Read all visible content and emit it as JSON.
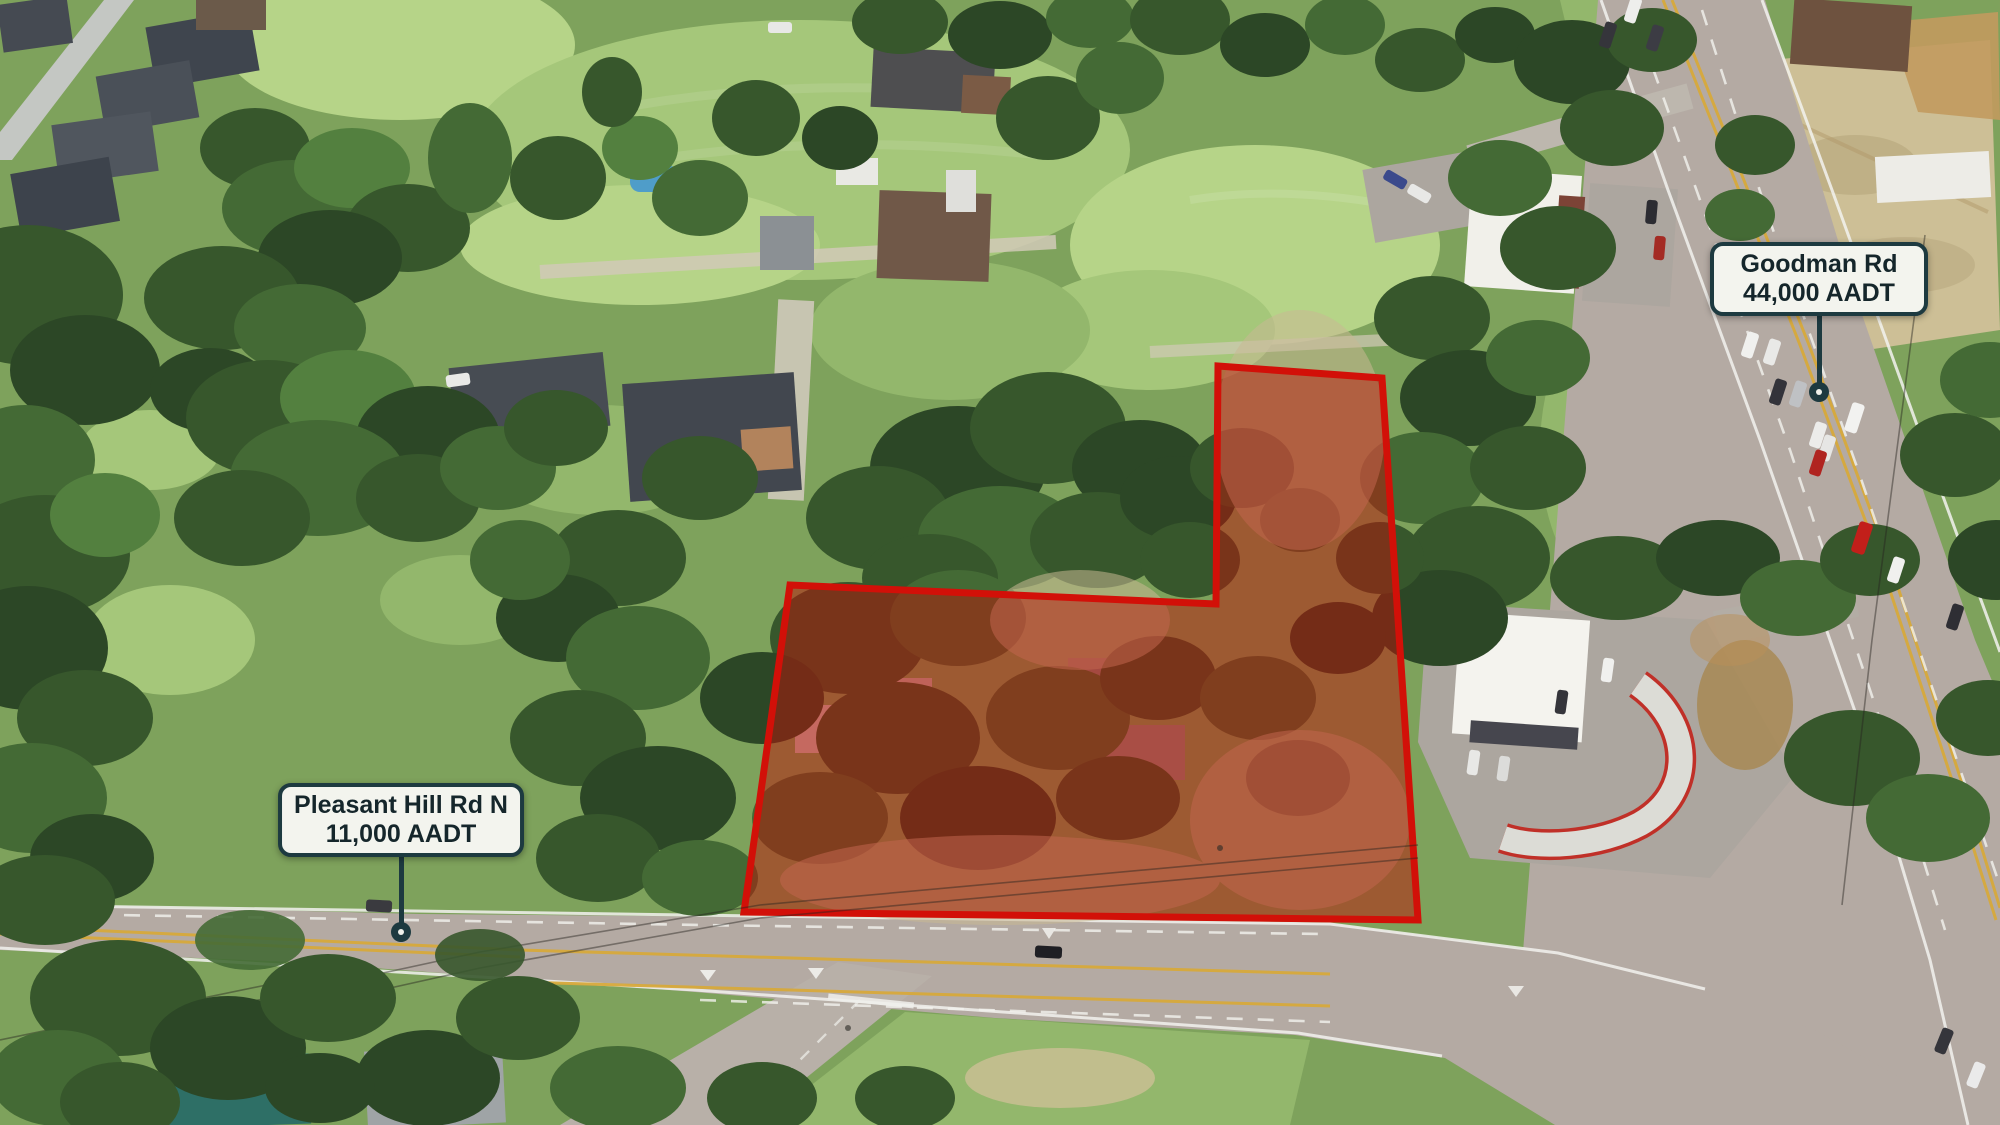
{
  "scene": {
    "width": 2000,
    "height": 1125
  },
  "parcel": {
    "points": [
      [
        1218,
        366
      ],
      [
        1382,
        378
      ],
      [
        1418,
        920
      ],
      [
        744,
        912
      ],
      [
        790,
        585
      ],
      [
        1216,
        604
      ]
    ],
    "fill": "#bb1208",
    "fill_opacity": 0.5,
    "stroke": "#d21008",
    "stroke_width": 7
  },
  "callout_style": {
    "background": "#f3f4ee",
    "border_color": "#1d3a40",
    "text_color": "#15262b",
    "line_color": "#1d3a40"
  },
  "labels": [
    {
      "id": "goodman-rd",
      "line1": "Goodman Rd",
      "line2": "44,000 AADT",
      "box": {
        "cx": 1819,
        "top": 242,
        "width": 218,
        "height": 66
      },
      "anchor": {
        "x": 1819,
        "y": 392
      }
    },
    {
      "id": "pleasant-hill-rd-n",
      "line1": "Pleasant Hill Rd N",
      "line2": "11,000 AADT",
      "box": {
        "cx": 401,
        "top": 783,
        "width": 218,
        "height": 61
      },
      "anchor": {
        "x": 401,
        "y": 932
      }
    }
  ]
}
